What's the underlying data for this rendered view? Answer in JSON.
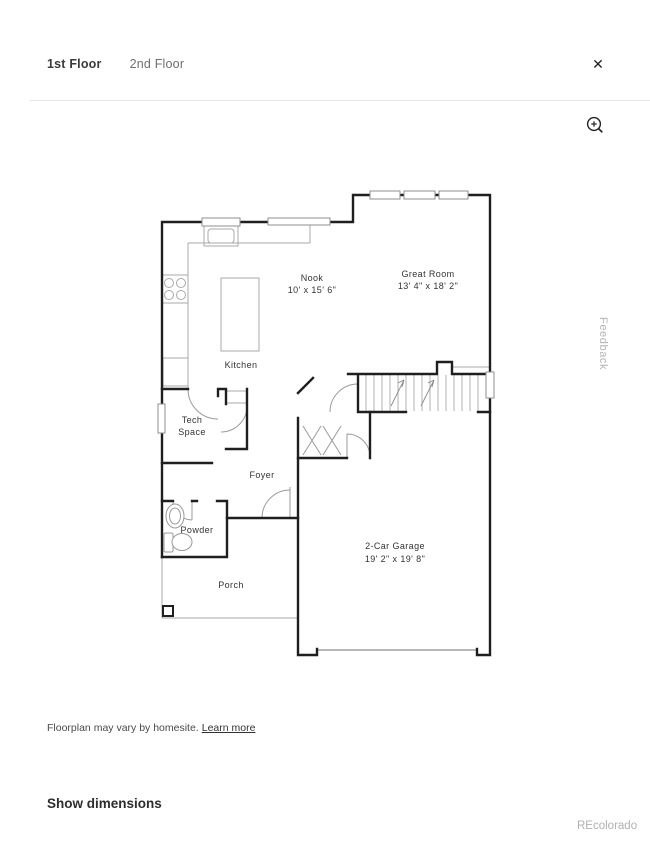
{
  "header": {
    "tabs": [
      {
        "label": "1st Floor",
        "active": true
      },
      {
        "label": "2nd Floor",
        "active": false
      }
    ],
    "close_glyph": "✕"
  },
  "plan": {
    "nook": {
      "name": "Nook",
      "dims": "10' x 15' 6\""
    },
    "great_room": {
      "name": "Great Room",
      "dims": "13' 4\" x 18' 2\""
    },
    "kitchen": {
      "name": "Kitchen"
    },
    "tech_space": {
      "line1": "Tech",
      "line2": "Space"
    },
    "foyer": {
      "name": "Foyer"
    },
    "powder": {
      "name": "Powder"
    },
    "porch": {
      "name": "Porch"
    },
    "garage": {
      "name": "2-Car Garage",
      "dims": "19' 2\" x 19' 8\""
    }
  },
  "side": {
    "feedback": "Feedback"
  },
  "footer": {
    "disclaimer": "Floorplan may vary by homesite.",
    "learn_more": "Learn more",
    "show_dimensions": "Show dimensions"
  },
  "watermark": {
    "text": "REcolorado"
  },
  "colors": {
    "wall": "#1f1f1f",
    "thin_line": "#a9a9a9",
    "divider": "#e7e7e7",
    "text_primary": "#2e2e2e",
    "text_secondary": "#6f6f6f",
    "text_muted": "#b3b3b3"
  }
}
